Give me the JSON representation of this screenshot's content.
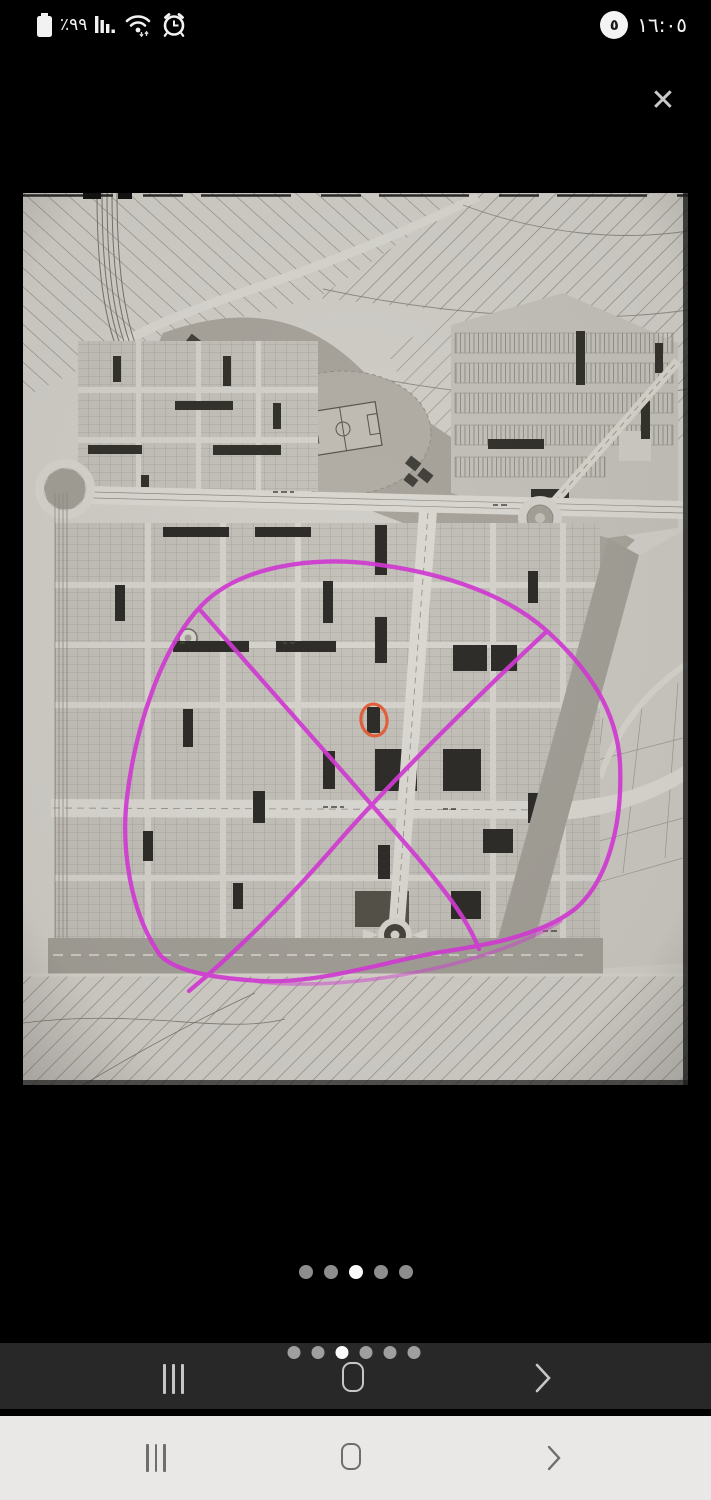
{
  "status_bar": {
    "battery_percent": "٪٩٩",
    "time": "١٦:٠٥",
    "notification_badge_count": "٥",
    "left_icons": [
      "battery-icon",
      "signal-bars-icon",
      "wifi-icon",
      "alarm-clock-icon"
    ]
  },
  "viewer": {
    "close_glyph": "✕",
    "pager": {
      "dot_count": 5,
      "active_index": 3
    }
  },
  "system_nav_dark": {
    "pager": {
      "dot_count": 6,
      "active_index": 3
    },
    "buttons": [
      "recents-button",
      "home-button",
      "back-button"
    ]
  },
  "system_nav_light": {
    "buttons": [
      "recents-button",
      "home-button",
      "back-button"
    ]
  },
  "annotation_colors": {
    "pen_magenta": "#cf3ad0",
    "pen_orange": "#e0603c"
  }
}
